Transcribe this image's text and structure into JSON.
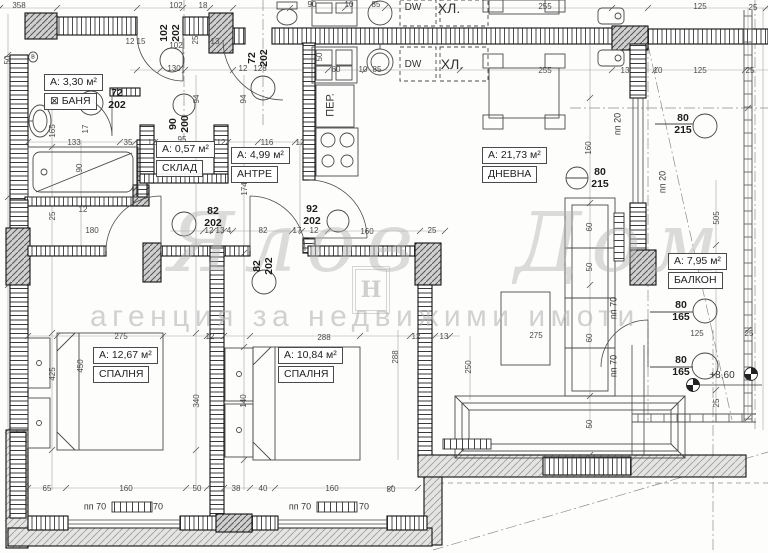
{
  "watermark": {
    "script": "Ялов Дом",
    "logo_letter": "Н",
    "subtitle": "агенция за недвижими имоти"
  },
  "rooms": [
    {
      "area": "А: 3,30 м²",
      "name": "БАНЯ",
      "x": 44,
      "y": 74,
      "sq": 1
    },
    {
      "area": "А: 0,57 м²",
      "name": "СКЛАД",
      "x": 156,
      "y": 141
    },
    {
      "area": "А: 4,99 м²",
      "name": "АНТРЕ",
      "x": 231,
      "y": 147
    },
    {
      "area": "А: 21,73 м²",
      "name": "ДНЕВНА",
      "x": 482,
      "y": 147
    },
    {
      "area": "А: 12,67 м²",
      "name": "СПАЛНЯ",
      "x": 93,
      "y": 347
    },
    {
      "area": "А: 10,84 м²",
      "name": "СПАЛНЯ",
      "x": 278,
      "y": 347
    },
    {
      "area": "А: 7,95 м²",
      "name": "БАЛКОН",
      "x": 668,
      "y": 253
    }
  ],
  "door_labels": [
    {
      "a": "72",
      "b": "202",
      "x": 117,
      "y": 99
    },
    {
      "a": "102",
      "b": "202",
      "x": 170,
      "y": 33,
      "r": 1
    },
    {
      "a": "72",
      "b": "202",
      "x": 258,
      "y": 58,
      "r": 1
    },
    {
      "a": "90",
      "b": "200",
      "x": 179,
      "y": 124,
      "r": 1
    },
    {
      "a": "82",
      "b": "202",
      "x": 213,
      "y": 217
    },
    {
      "a": "82",
      "b": "202",
      "x": 263,
      "y": 266,
      "r": 1
    },
    {
      "a": "92",
      "b": "202",
      "x": 312,
      "y": 215
    },
    {
      "a": "80",
      "b": "215",
      "x": 600,
      "y": 178
    },
    {
      "a": "80",
      "b": "215",
      "x": 683,
      "y": 124
    },
    {
      "a": "80",
      "b": "165",
      "x": 681,
      "y": 311
    },
    {
      "a": "80",
      "b": "165",
      "x": 681,
      "y": 366
    }
  ],
  "dims": [
    {
      "t": "358",
      "x": 19,
      "y": 6
    },
    {
      "t": "102",
      "x": 176,
      "y": 6
    },
    {
      "t": "18",
      "x": 203,
      "y": 6
    },
    {
      "t": "90",
      "x": 312,
      "y": 5
    },
    {
      "t": "10",
      "x": 349,
      "y": 5
    },
    {
      "t": "85",
      "x": 376,
      "y": 5
    },
    {
      "t": "255",
      "x": 545,
      "y": 7
    },
    {
      "t": "125",
      "x": 700,
      "y": 7
    },
    {
      "t": "25",
      "x": 753,
      "y": 8
    },
    {
      "t": "12",
      "x": 130,
      "y": 42
    },
    {
      "t": "15",
      "x": 141,
      "y": 42
    },
    {
      "t": "102",
      "x": 176,
      "y": 46
    },
    {
      "t": "13",
      "x": 215,
      "y": 42
    },
    {
      "t": "25",
      "x": 196,
      "y": 40,
      "r": 1
    },
    {
      "t": "130",
      "x": 174,
      "y": 69
    },
    {
      "t": "12",
      "x": 243,
      "y": 69
    },
    {
      "t": "128",
      "x": 260,
      "y": 69
    },
    {
      "t": "50",
      "x": 320,
      "y": 57,
      "r": 1
    },
    {
      "t": "60",
      "x": 336,
      "y": 70
    },
    {
      "t": "10",
      "x": 363,
      "y": 70
    },
    {
      "t": "85",
      "x": 377,
      "y": 70
    },
    {
      "t": "255",
      "x": 545,
      "y": 71
    },
    {
      "t": "13",
      "x": 625,
      "y": 71
    },
    {
      "t": "10",
      "x": 658,
      "y": 71
    },
    {
      "t": "125",
      "x": 700,
      "y": 71
    },
    {
      "t": "25",
      "x": 750,
      "y": 71
    },
    {
      "t": "94",
      "x": 197,
      "y": 99,
      "r": 1
    },
    {
      "t": "94",
      "x": 244,
      "y": 99,
      "r": 1
    },
    {
      "t": "50",
      "x": 8,
      "y": 60,
      "r": 1
    },
    {
      "t": "165",
      "x": 53,
      "y": 131,
      "r": 1
    },
    {
      "t": "17",
      "x": 86,
      "y": 129,
      "r": 1
    },
    {
      "t": "90",
      "x": 80,
      "y": 168,
      "r": 1
    },
    {
      "t": "133",
      "x": 74,
      "y": 143
    },
    {
      "t": "35",
      "x": 128,
      "y": 143
    },
    {
      "t": "12",
      "x": 152,
      "y": 143
    },
    {
      "t": "95",
      "x": 182,
      "y": 140
    },
    {
      "t": "12",
      "x": 221,
      "y": 143
    },
    {
      "t": "116",
      "x": 267,
      "y": 143
    },
    {
      "t": "12",
      "x": 300,
      "y": 143
    },
    {
      "t": "174",
      "x": 245,
      "y": 189,
      "r": 1
    },
    {
      "t": "180",
      "x": 92,
      "y": 231
    },
    {
      "t": "25",
      "x": 53,
      "y": 216,
      "r": 1
    },
    {
      "t": "12",
      "x": 83,
      "y": 210
    },
    {
      "t": "12",
      "x": 209,
      "y": 231
    },
    {
      "t": "13",
      "x": 220,
      "y": 231
    },
    {
      "t": "4",
      "x": 229,
      "y": 231
    },
    {
      "t": "82",
      "x": 263,
      "y": 231
    },
    {
      "t": "17",
      "x": 297,
      "y": 231
    },
    {
      "t": "12",
      "x": 314,
      "y": 231
    },
    {
      "t": "160",
      "x": 367,
      "y": 232
    },
    {
      "t": "25",
      "x": 432,
      "y": 231
    },
    {
      "t": "275",
      "x": 121,
      "y": 337
    },
    {
      "t": "12",
      "x": 210,
      "y": 337
    },
    {
      "t": "288",
      "x": 324,
      "y": 338
    },
    {
      "t": "12",
      "x": 416,
      "y": 337
    },
    {
      "t": "13",
      "x": 444,
      "y": 337
    },
    {
      "t": "275",
      "x": 536,
      "y": 336
    },
    {
      "t": "450",
      "x": 81,
      "y": 366,
      "r": 1
    },
    {
      "t": "425",
      "x": 53,
      "y": 374,
      "r": 1
    },
    {
      "t": "340",
      "x": 197,
      "y": 401,
      "r": 1
    },
    {
      "t": "140",
      "x": 244,
      "y": 401,
      "r": 1
    },
    {
      "t": "288",
      "x": 396,
      "y": 357,
      "r": 1
    },
    {
      "t": "250",
      "x": 469,
      "y": 367,
      "r": 1
    },
    {
      "t": "160",
      "x": 589,
      "y": 148,
      "r": 1
    },
    {
      "t": "60",
      "x": 590,
      "y": 227,
      "r": 1
    },
    {
      "t": "50",
      "x": 590,
      "y": 267,
      "r": 1
    },
    {
      "t": "60",
      "x": 590,
      "y": 338,
      "r": 1
    },
    {
      "t": "50",
      "x": 590,
      "y": 424,
      "r": 1
    },
    {
      "t": "505",
      "x": 717,
      "y": 218,
      "r": 1
    },
    {
      "t": "25",
      "x": 717,
      "y": 403,
      "r": 1
    },
    {
      "t": "125",
      "x": 697,
      "y": 334
    },
    {
      "t": "25",
      "x": 749,
      "y": 334
    },
    {
      "t": "65",
      "x": 47,
      "y": 489
    },
    {
      "t": "160",
      "x": 126,
      "y": 489
    },
    {
      "t": "50",
      "x": 197,
      "y": 489
    },
    {
      "t": "38",
      "x": 236,
      "y": 489
    },
    {
      "t": "40",
      "x": 263,
      "y": 489
    },
    {
      "t": "160",
      "x": 332,
      "y": 489
    },
    {
      "t": "50",
      "x": 391,
      "y": 490
    }
  ],
  "texts": [
    {
      "t": "ПЕР.",
      "x": 331,
      "y": 105,
      "r": 1,
      "s": 11
    },
    {
      "t": "DW",
      "x": 413,
      "y": 8,
      "s": 10
    },
    {
      "t": "ХЛ.",
      "x": 449,
      "y": 8,
      "s": 14
    },
    {
      "t": "DW",
      "x": 413,
      "y": 65,
      "s": 10
    },
    {
      "t": "ХЛ.",
      "x": 452,
      "y": 64,
      "s": 14
    },
    {
      "t": "пп 20",
      "x": 618,
      "y": 124,
      "r": 1,
      "s": 9
    },
    {
      "t": "пп 20",
      "x": 663,
      "y": 182,
      "r": 1,
      "s": 9
    },
    {
      "t": "пп 70",
      "x": 614,
      "y": 308,
      "r": 1,
      "s": 9
    },
    {
      "t": "пп 70",
      "x": 614,
      "y": 366,
      "r": 1,
      "s": 9
    },
    {
      "t": "пп 70",
      "x": 95,
      "y": 507,
      "s": 9
    },
    {
      "t": "70",
      "x": 158,
      "y": 507,
      "s": 9
    },
    {
      "t": "пп 70",
      "x": 300,
      "y": 507,
      "s": 9
    },
    {
      "t": "70",
      "x": 364,
      "y": 507,
      "s": 9
    },
    {
      "t": "+8,60",
      "x": 722,
      "y": 376,
      "s": 10
    },
    {
      "t": "в",
      "x": 33,
      "y": 57,
      "s": 7,
      "c": 1
    }
  ],
  "colors": {
    "wall_line": "#111111",
    "dim_line": "#999999",
    "dim_text": "#4b4b4b",
    "watermark": "#b3b3b3"
  }
}
